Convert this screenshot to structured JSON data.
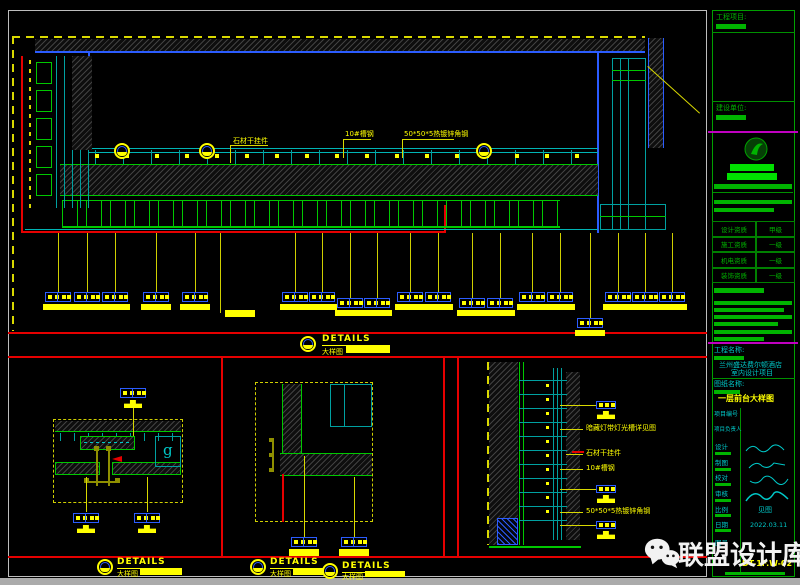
{
  "colors": {
    "yellow": "#ffff00",
    "green": "#00c000",
    "cyan": "#00c8c8",
    "blue": "#2b5cff",
    "red": "#e60000",
    "magenta": "#c000c0"
  },
  "watermark": {
    "brand": "联盟设计库"
  },
  "detail_titles": [
    {
      "label": "DETAILS",
      "sub": "大样图"
    },
    {
      "label": "DETAILS",
      "sub": "大样图"
    },
    {
      "label": "DETAILS",
      "sub": "大样图"
    },
    {
      "label": "DETAILS",
      "sub": "大样图"
    }
  ],
  "callouts": {
    "top": [
      "石材干挂件",
      "10#槽钢",
      "50*50*5热镀锌角钢"
    ],
    "right_detail": [
      "暗藏灯带灯光槽详见图",
      "石材干挂件",
      "10#槽钢",
      "50*50*5热镀锌角钢"
    ]
  },
  "symbols": {
    "section_letter": "g"
  },
  "title_block": {
    "project_section_label": "工程项目:",
    "client_section_label": "建设单位:",
    "qualifications": [
      {
        "label": "设计资质",
        "value": "甲级"
      },
      {
        "label": "施工资质",
        "value": "一级"
      },
      {
        "label": "机电资质",
        "value": "一级"
      },
      {
        "label": "装饰资质",
        "value": "一级"
      }
    ],
    "project_name_label": "工程名称:",
    "project_name_line1": "兰州盛达费尔顿酒店",
    "project_name_line2": "室内设计项目",
    "drawing_name_label": "图纸名称:",
    "drawing_name": "一层前台大样图",
    "fields": [
      {
        "label": "项目编号",
        "value": ""
      },
      {
        "label": "项目负责人",
        "value": ""
      },
      {
        "label": "设计",
        "value": ""
      },
      {
        "label": "制图",
        "value": ""
      },
      {
        "label": "校对",
        "value": ""
      },
      {
        "label": "审核",
        "value": ""
      },
      {
        "label": "比例",
        "value": "见图"
      },
      {
        "label": "日期",
        "value": "2022.03.11"
      },
      {
        "label": "图号",
        "value": "DT-1F.W-02"
      }
    ]
  }
}
